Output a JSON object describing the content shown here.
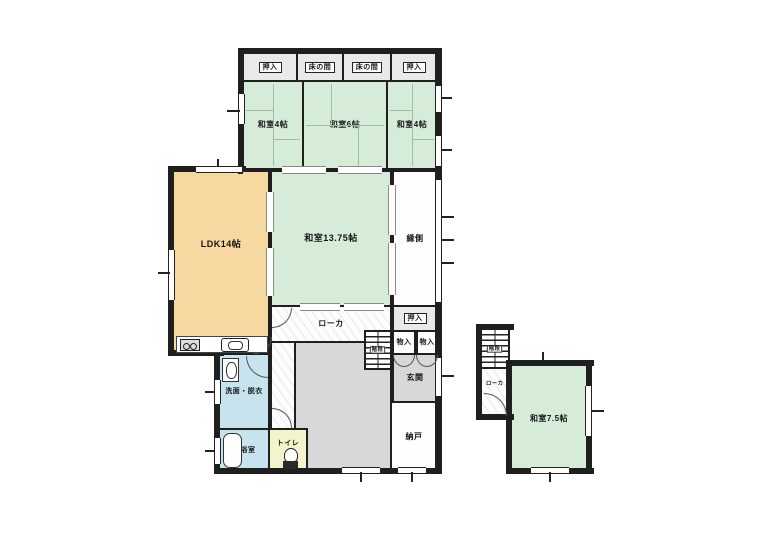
{
  "plan_type": "japanese-house-floor-plan",
  "labels": {
    "oshiire": "押入",
    "tokonoma": "床の間",
    "washitsu4": "和室4帖",
    "washitsu6": "和室6帖",
    "washitsu1375": "和室13.75帖",
    "ldk": "LDK14帖",
    "engawa": "縁側",
    "roka": "ローカ",
    "kaidan": "階段",
    "monoire": "物入",
    "genkan": "玄関",
    "nando": "納戸",
    "senmen": "洗面・脱衣",
    "yokushitsu": "浴室",
    "toire": "トイレ",
    "washitsu75": "和室7.5帖"
  },
  "icons": {
    "stove": "stove-icon",
    "sink": "sink-icon",
    "washbasin": "washbasin-icon",
    "bathtub": "bathtub-icon",
    "toilet": "toilet-icon",
    "stairs": "stairs-hatch-icon"
  },
  "colors": {
    "wall": "#1f1f1f",
    "tatami": "#d6ebd8",
    "ldk": "#f7d8a1",
    "water": "#c7e4ee",
    "toilet_floor": "#f4f4cc",
    "doma": "#d8d8d8",
    "closet": "#e9e9e9",
    "line": "#9bbfa3"
  }
}
